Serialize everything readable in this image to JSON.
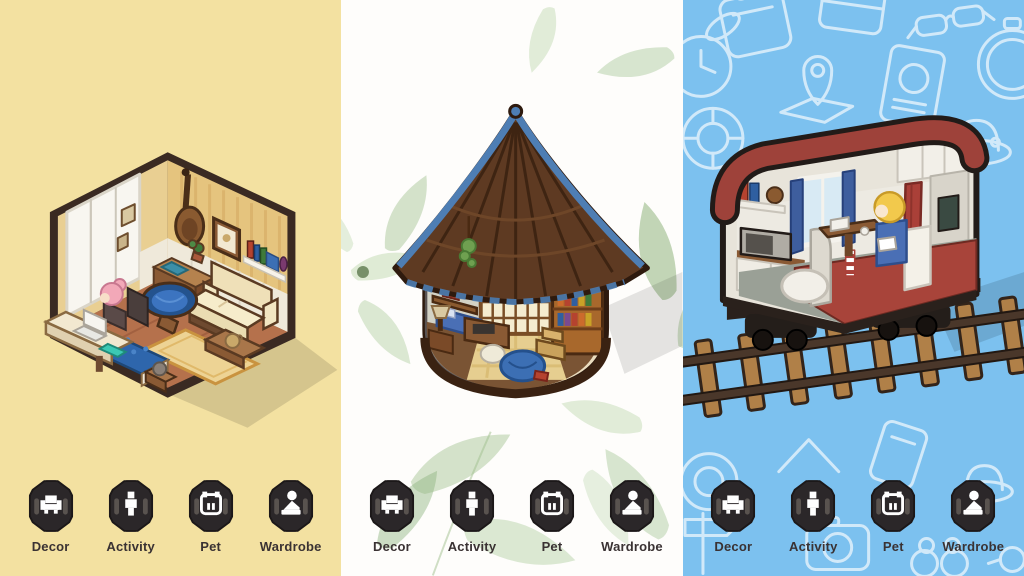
{
  "screen": {
    "width": 1024,
    "height": 576
  },
  "panels": [
    {
      "name": "bedroom",
      "background_color": "#F3E1A1",
      "scene": {
        "name": "pixel-bedroom-scene",
        "description": "isometric cutaway bedroom: yellow striped wallpaper with white wainscot, sliding window, cello and frames on wall, wall shelf with books, desk with laptop and pink-haired character, papasan chair with blue cushion, cream sofa, blue bed, plaid rug, low table with cat"
      },
      "menu": {
        "items": [
          {
            "label": "Decor",
            "icon": "armchair-icon"
          },
          {
            "label": "Activity",
            "icon": "person-icon"
          },
          {
            "label": "Pet",
            "icon": "cat-face-icon"
          },
          {
            "label": "Wardrobe",
            "icon": "mannequin-icon"
          }
        ]
      }
    },
    {
      "name": "library-hut",
      "background_color": "#FEFDFB",
      "decorations": [
        "watercolor-leaf",
        "watercolor-flower"
      ],
      "scene": {
        "name": "pixel-library-hut-scene",
        "description": "round hut with brown shingled roof and blue trim, cutaway library interior: arched window, tall bookshelf, step stool, wall shelves with plants, desk and chair, blue beanbag with red book, sunlight pool on wooden floor"
      },
      "menu": {
        "items": [
          {
            "label": "Decor",
            "icon": "armchair-icon"
          },
          {
            "label": "Activity",
            "icon": "person-icon"
          },
          {
            "label": "Pet",
            "icon": "cat-face-icon"
          },
          {
            "label": "Wardrobe",
            "icon": "mannequin-icon"
          }
        ]
      }
    },
    {
      "name": "train-car",
      "background_color": "#7CC1EF",
      "decorations": [
        "suitcase",
        "wallet",
        "sunglasses",
        "rabbit-clock",
        "map-pin",
        "passport",
        "stopwatch",
        "life-ring",
        "sun-hat",
        "mountain",
        "camera",
        "phone",
        "binoculars",
        "signpost"
      ],
      "scene": {
        "name": "pixel-train-car-scene",
        "description": "cutaway sleeper train car on railway tracks: kitchenette with microwave and shelf, window with blue curtains, red curtain, table with blonde character reading, white beanbag, gray partition, red open deck, dark bogies and wheels"
      },
      "menu": {
        "items": [
          {
            "label": "Decor",
            "icon": "armchair-icon"
          },
          {
            "label": "Activity",
            "icon": "person-icon"
          },
          {
            "label": "Pet",
            "icon": "cat-face-icon"
          },
          {
            "label": "Wardrobe",
            "icon": "mannequin-icon"
          }
        ]
      }
    }
  ],
  "colors": {
    "menu_button": "#2B2729",
    "menu_button_accent": "#59534F",
    "menu_icon": "#FFFFFF",
    "menu_label": "#3A3233",
    "bedroom_background": "#F3E1A1",
    "train_background": "#7CC1EF",
    "hut_roof_brown": "#5E3A22",
    "roof_trim_blue": "#4E7EB4",
    "papasan_blue": "#2E66AC",
    "deck_red": "#A8443A"
  }
}
